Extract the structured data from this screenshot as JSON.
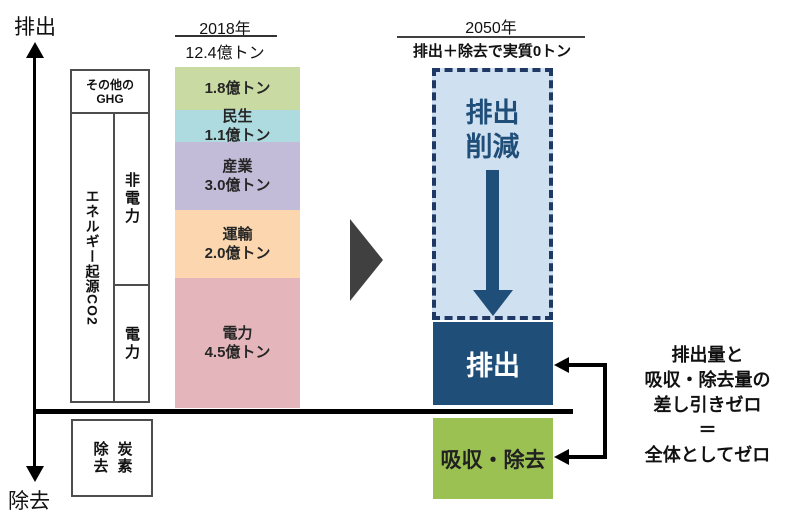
{
  "colors": {
    "seg_other_ghg": "#c9daa2",
    "seg_minsei": "#aedbdf",
    "seg_sangyo": "#c3bcd8",
    "seg_unyu": "#fbd6ae",
    "seg_denryoku": "#e4b6bb",
    "reduction_fill": "#cfe0f1",
    "reduction_border": "#1f3864",
    "emission_box": "#1f4e79",
    "absorption_box": "#9cc153",
    "transition_triangle": "#404040",
    "axis": "#000000"
  },
  "axes": {
    "top_label": "排出",
    "bottom_label": "除去"
  },
  "left_panel": {
    "other_ghg_line1": "その他の",
    "other_ghg_line2": "GHG",
    "energy_co2": "エネルギー起源CO2",
    "non_power": "非電力",
    "power": "電力",
    "carbon_removal_left_col": "除去",
    "carbon_removal_right_col": "炭素"
  },
  "col_2018": {
    "year": "2018年",
    "total": "12.4億トン"
  },
  "col_2050": {
    "year": "2050年",
    "subtitle": "排出＋除去で実質0トン",
    "reduction_line1": "排出",
    "reduction_line2": "削減",
    "emission_label": "排出",
    "absorption_label": "吸収・除去"
  },
  "note": {
    "line1": "排出量と",
    "line2": "吸収・除去量の",
    "line3": "差し引きゼロ",
    "line4": "＝",
    "line5": "全体としてゼロ"
  },
  "chart_data": {
    "type": "bar",
    "title": "2018年 12.4億トン → 2050年 排出＋除去で実質0トン",
    "ylabel_positive": "排出",
    "ylabel_negative": "除去",
    "unit": "億トン",
    "total_2018": 12.4,
    "net_target_2050": 0,
    "categories": [
      "その他のGHG",
      "民生",
      "産業",
      "運輸",
      "電力"
    ],
    "values": [
      1.8,
      1.1,
      3.0,
      2.0,
      4.5
    ],
    "segments": [
      {
        "line1": "1.8億トン",
        "line2": "",
        "value": 1.8,
        "color": "#c9daa2"
      },
      {
        "line1": "民生",
        "line2": "1.1億トン",
        "value": 1.1,
        "color": "#aedbdf"
      },
      {
        "line1": "産業",
        "line2": "3.0億トン",
        "value": 3.0,
        "color": "#c3bcd8"
      },
      {
        "line1": "運輸",
        "line2": "2.0億トン",
        "value": 2.0,
        "color": "#fbd6ae"
      },
      {
        "line1": "電力",
        "line2": "4.5億トン",
        "value": 4.5,
        "color": "#e4b6bb"
      }
    ],
    "target_2050_blocks": [
      {
        "name": "排出削減",
        "style": "dashed-light-blue"
      },
      {
        "name": "排出",
        "style": "solid-dark-blue"
      },
      {
        "name": "吸収・除去",
        "style": "solid-green",
        "below_axis": true
      }
    ],
    "legend_position": "none",
    "grid": false
  }
}
